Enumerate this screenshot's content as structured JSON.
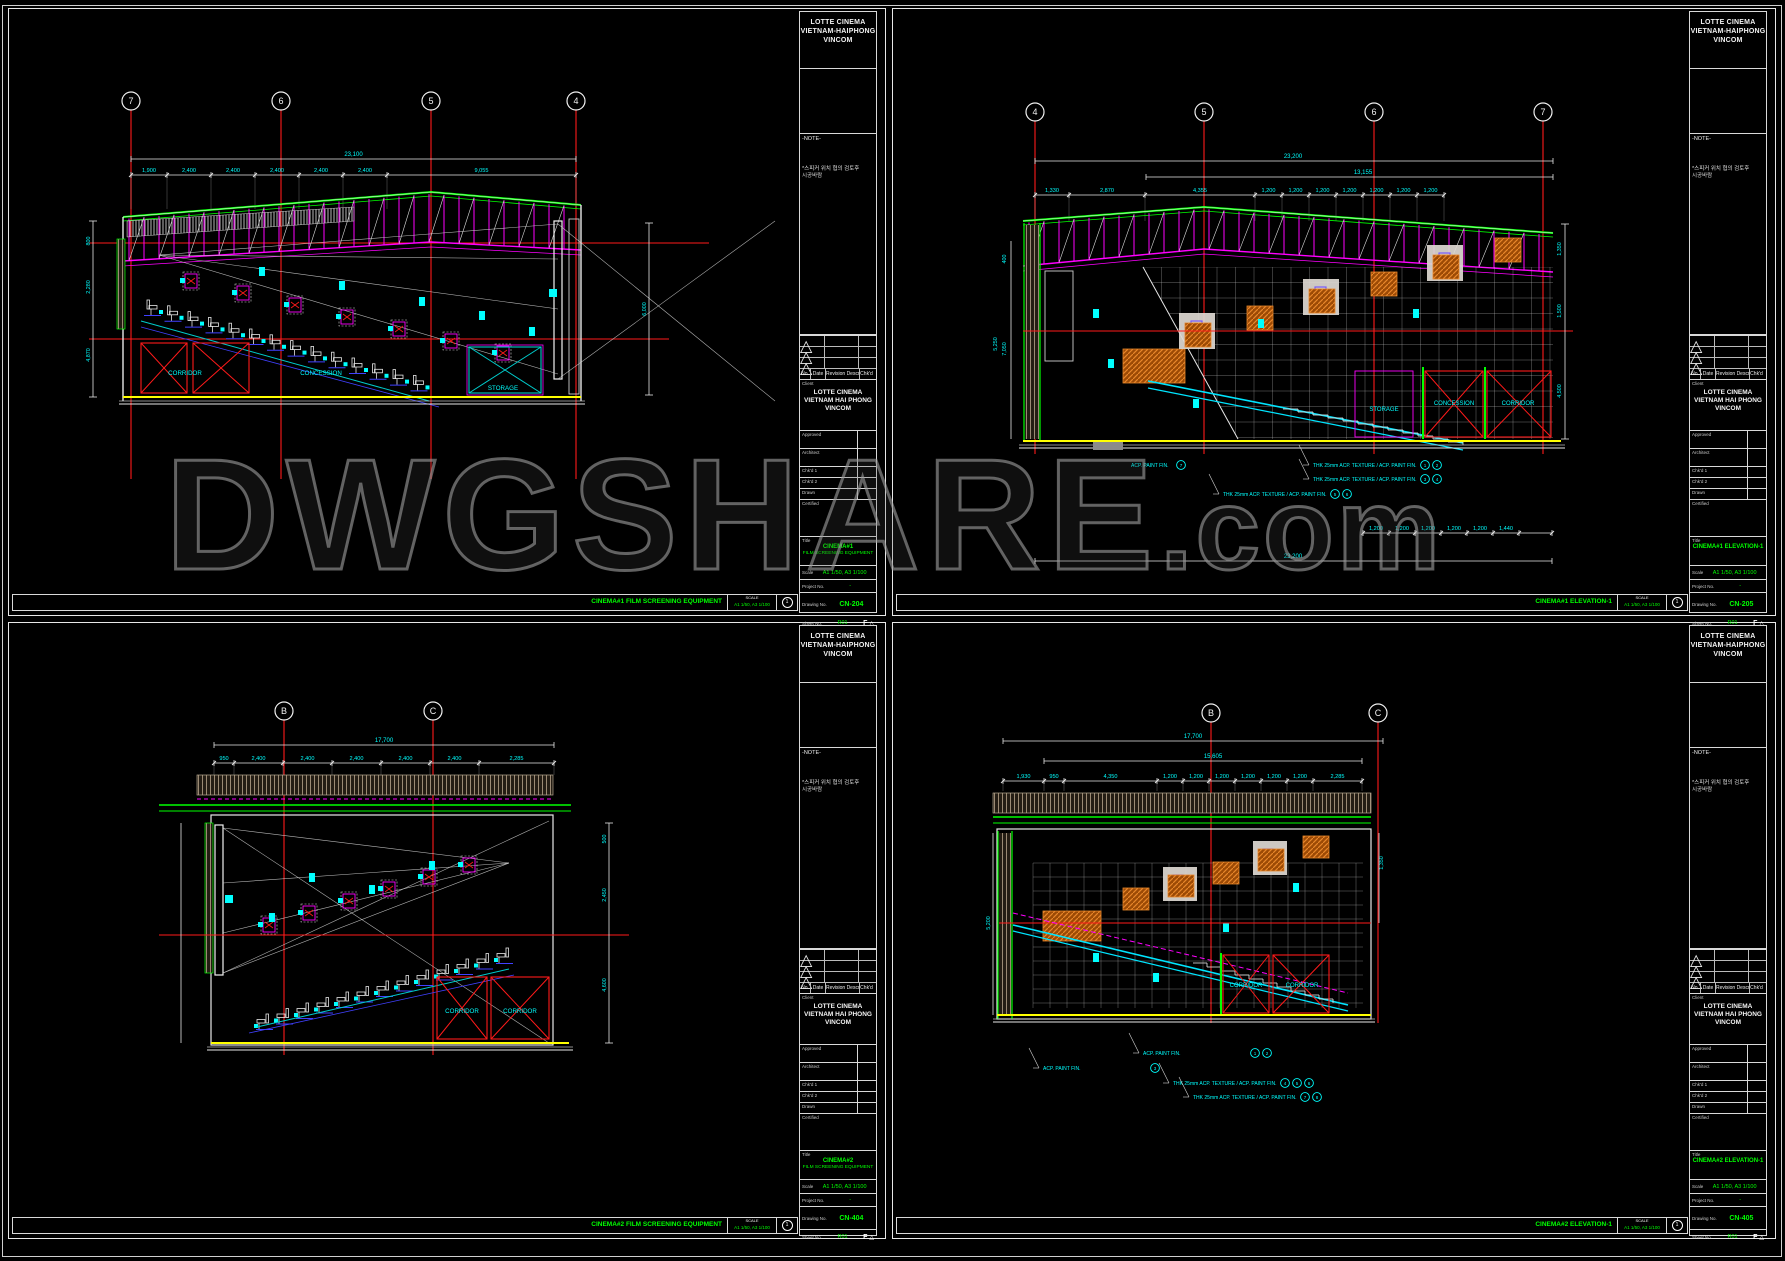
{
  "watermark": {
    "text": "DWGSHARE",
    "suffix": ".com"
  },
  "colors": {
    "background": "#000000",
    "border": "#e8e8e8",
    "grid_line_red": "#ff1a1a",
    "dimension_cyan": "#00ffff",
    "linework_green": "#00ff00",
    "linework_magenta": "#ff00ff",
    "floor_yellow": "#ffff00",
    "speaker_orange": "#c46312",
    "seat_blue": "#4040ff",
    "title_green": "#00ff00",
    "watermark_grey": "#8f8f8f"
  },
  "common": {
    "header": [
      "LOTTE CINEMA",
      "VIETNAM-HAIPHONG",
      "VINCOM"
    ],
    "note_label": "-NOTE-",
    "note_lines": [
      "*스피커 위치 협의 검토후",
      "시공바람"
    ],
    "rev_headers": [
      "No.",
      "Date",
      "Revision Description",
      "Chk'd"
    ],
    "rev_mark": "△",
    "client_label": "Client",
    "client_name": [
      "LOTTE CINEMA",
      "VIETNAM HAI PHONG",
      "VINCOM"
    ],
    "signoff_labels": [
      "Approved",
      "Architect",
      "Chk'd 1",
      "Chk'd 2",
      "Drawn"
    ],
    "certified_label": "Certified",
    "title_label": "Title",
    "scale_label": "Scale",
    "project_label": "Project No.",
    "dwgno_label": "Drawing No.",
    "sheetno_label": "Sheet No.",
    "strip_scale_label": "SCALE",
    "logo_letter": "F",
    "delta": "△"
  },
  "sheets": [
    {
      "id": "CN-204",
      "title_lines": [
        "CINEMA#1",
        "FILM SCREENING EQUIPMENT"
      ],
      "scale_value": "A1 1/50, A3 1/100",
      "project_value": "-",
      "dwgno_value": "CN-204",
      "sheetno_value": "R01",
      "strip_title": "CINEMA#1 FILM SCREENING EQUIPMENT",
      "strip_scale_value": "A1 1/50, A3 1/100",
      "strip_circle": "1",
      "drawing": {
        "bubbles": [
          "7",
          "6",
          "5",
          "4"
        ],
        "dim_overall": "23,100",
        "dim_segs": [
          "1,900",
          "2,400",
          "2,400",
          "2,400",
          "2,400",
          "2,400",
          "9,055"
        ],
        "vdims_left": [
          "800",
          "2,280",
          "4,870"
        ],
        "vdims_right": [
          "6,000"
        ],
        "rooms": [
          "CORRIDOR",
          "CONCESSION",
          "STORAGE"
        ]
      }
    },
    {
      "id": "CN-205",
      "title_lines": [
        "CINEMA#1 ELEVATION-1"
      ],
      "scale_value": "A1 1/50, A3 1/100",
      "project_value": "-",
      "dwgno_value": "CN-205",
      "sheetno_value": "R01",
      "strip_title": "CINEMA#1 ELEVATION-1",
      "strip_scale_value": "A1 1/50, A3 1/100",
      "strip_circle": "1",
      "drawing": {
        "bubbles": [
          "4",
          "5",
          "6",
          "7"
        ],
        "dim_overall": "23,200",
        "dim_sub": "13,155",
        "dim_segs": [
          "1,330",
          "2,870",
          "4,355",
          "1,200",
          "1,200",
          "1,200",
          "1,200",
          "1,200",
          "1,200",
          "1,200"
        ],
        "dim_bottom_segs": [
          "1,200",
          "1,200",
          "1,200",
          "1,200",
          "1,200",
          "1,440"
        ],
        "dim_bottom_overall": "23,200",
        "vdims_left": [
          "400",
          "5,250",
          "7,050"
        ],
        "vdims_right": [
          "1,350",
          "1,500",
          "4,500"
        ],
        "rooms": [
          "STORAGE",
          "CONCESSION",
          "CORRIDOR"
        ],
        "annotations": [
          "THK 25mm ACP. TEXTURE / ACP. PAINT FIN.",
          "THK 25mm ACP. TEXTURE / ACP. PAINT FIN.",
          "THK 25mm ACP. TEXTURE / ACP. PAINT FIN.",
          "ACP. PAINT FIN."
        ],
        "ann_circles": [
          "1",
          "2",
          "3",
          "4",
          "5",
          "6",
          "7"
        ]
      }
    },
    {
      "id": "CN-404",
      "title_lines": [
        "CINEMA#2",
        "FILM SCREENING EQUIPMENT"
      ],
      "scale_value": "A1 1/50, A3 1/100",
      "project_value": "-",
      "dwgno_value": "CN-404",
      "sheetno_value": "R01",
      "strip_title": "CINEMA#2 FILM SCREENING EQUIPMENT",
      "strip_scale_value": "A1 1/50, A3 1/100",
      "strip_circle": "1",
      "drawing": {
        "bubbles": [
          "B",
          "C"
        ],
        "dim_overall": "17,700",
        "dim_segs": [
          "950",
          "2,400",
          "2,400",
          "2,400",
          "2,400",
          "2,400",
          "2,285"
        ],
        "vdims_right": [
          "500",
          "2,450",
          "4,600"
        ],
        "rooms": [
          "CORRIDOR",
          "CORRIDOR"
        ]
      }
    },
    {
      "id": "CN-405",
      "title_lines": [
        "CINEMA#2 ELEVATION-1"
      ],
      "scale_value": "A1 1/50, A3 1/100",
      "project_value": "-",
      "dwgno_value": "CN-405",
      "sheetno_value": "R01",
      "strip_title": "CINEMA#2 ELEVATION-1",
      "strip_scale_value": "A1 1/50, A3 1/100",
      "strip_circle": "1",
      "drawing": {
        "bubbles": [
          "B",
          "C"
        ],
        "dim_overall": "17,700",
        "dim_sub": "15,605",
        "dim_segs": [
          "1,930",
          "950",
          "4,350",
          "1,200",
          "1,200",
          "1,200",
          "1,200",
          "1,200",
          "1,200",
          "2,285"
        ],
        "vdims_left": [
          "5,200"
        ],
        "vdims_right": [
          "1,350"
        ],
        "rooms": [
          "CORRIDOR",
          "CORRIDOR"
        ],
        "annotations": [
          "ACP. PAINT FIN.",
          "ACP. PAINT FIN.",
          "THK 25mm ACP. TEXTURE / ACP. PAINT FIN.",
          "THK 25mm ACP. TEXTURE / ACP. PAINT FIN."
        ],
        "ann_circles": [
          "1",
          "2",
          "3",
          "4",
          "5",
          "6",
          "7",
          "8"
        ]
      }
    }
  ]
}
